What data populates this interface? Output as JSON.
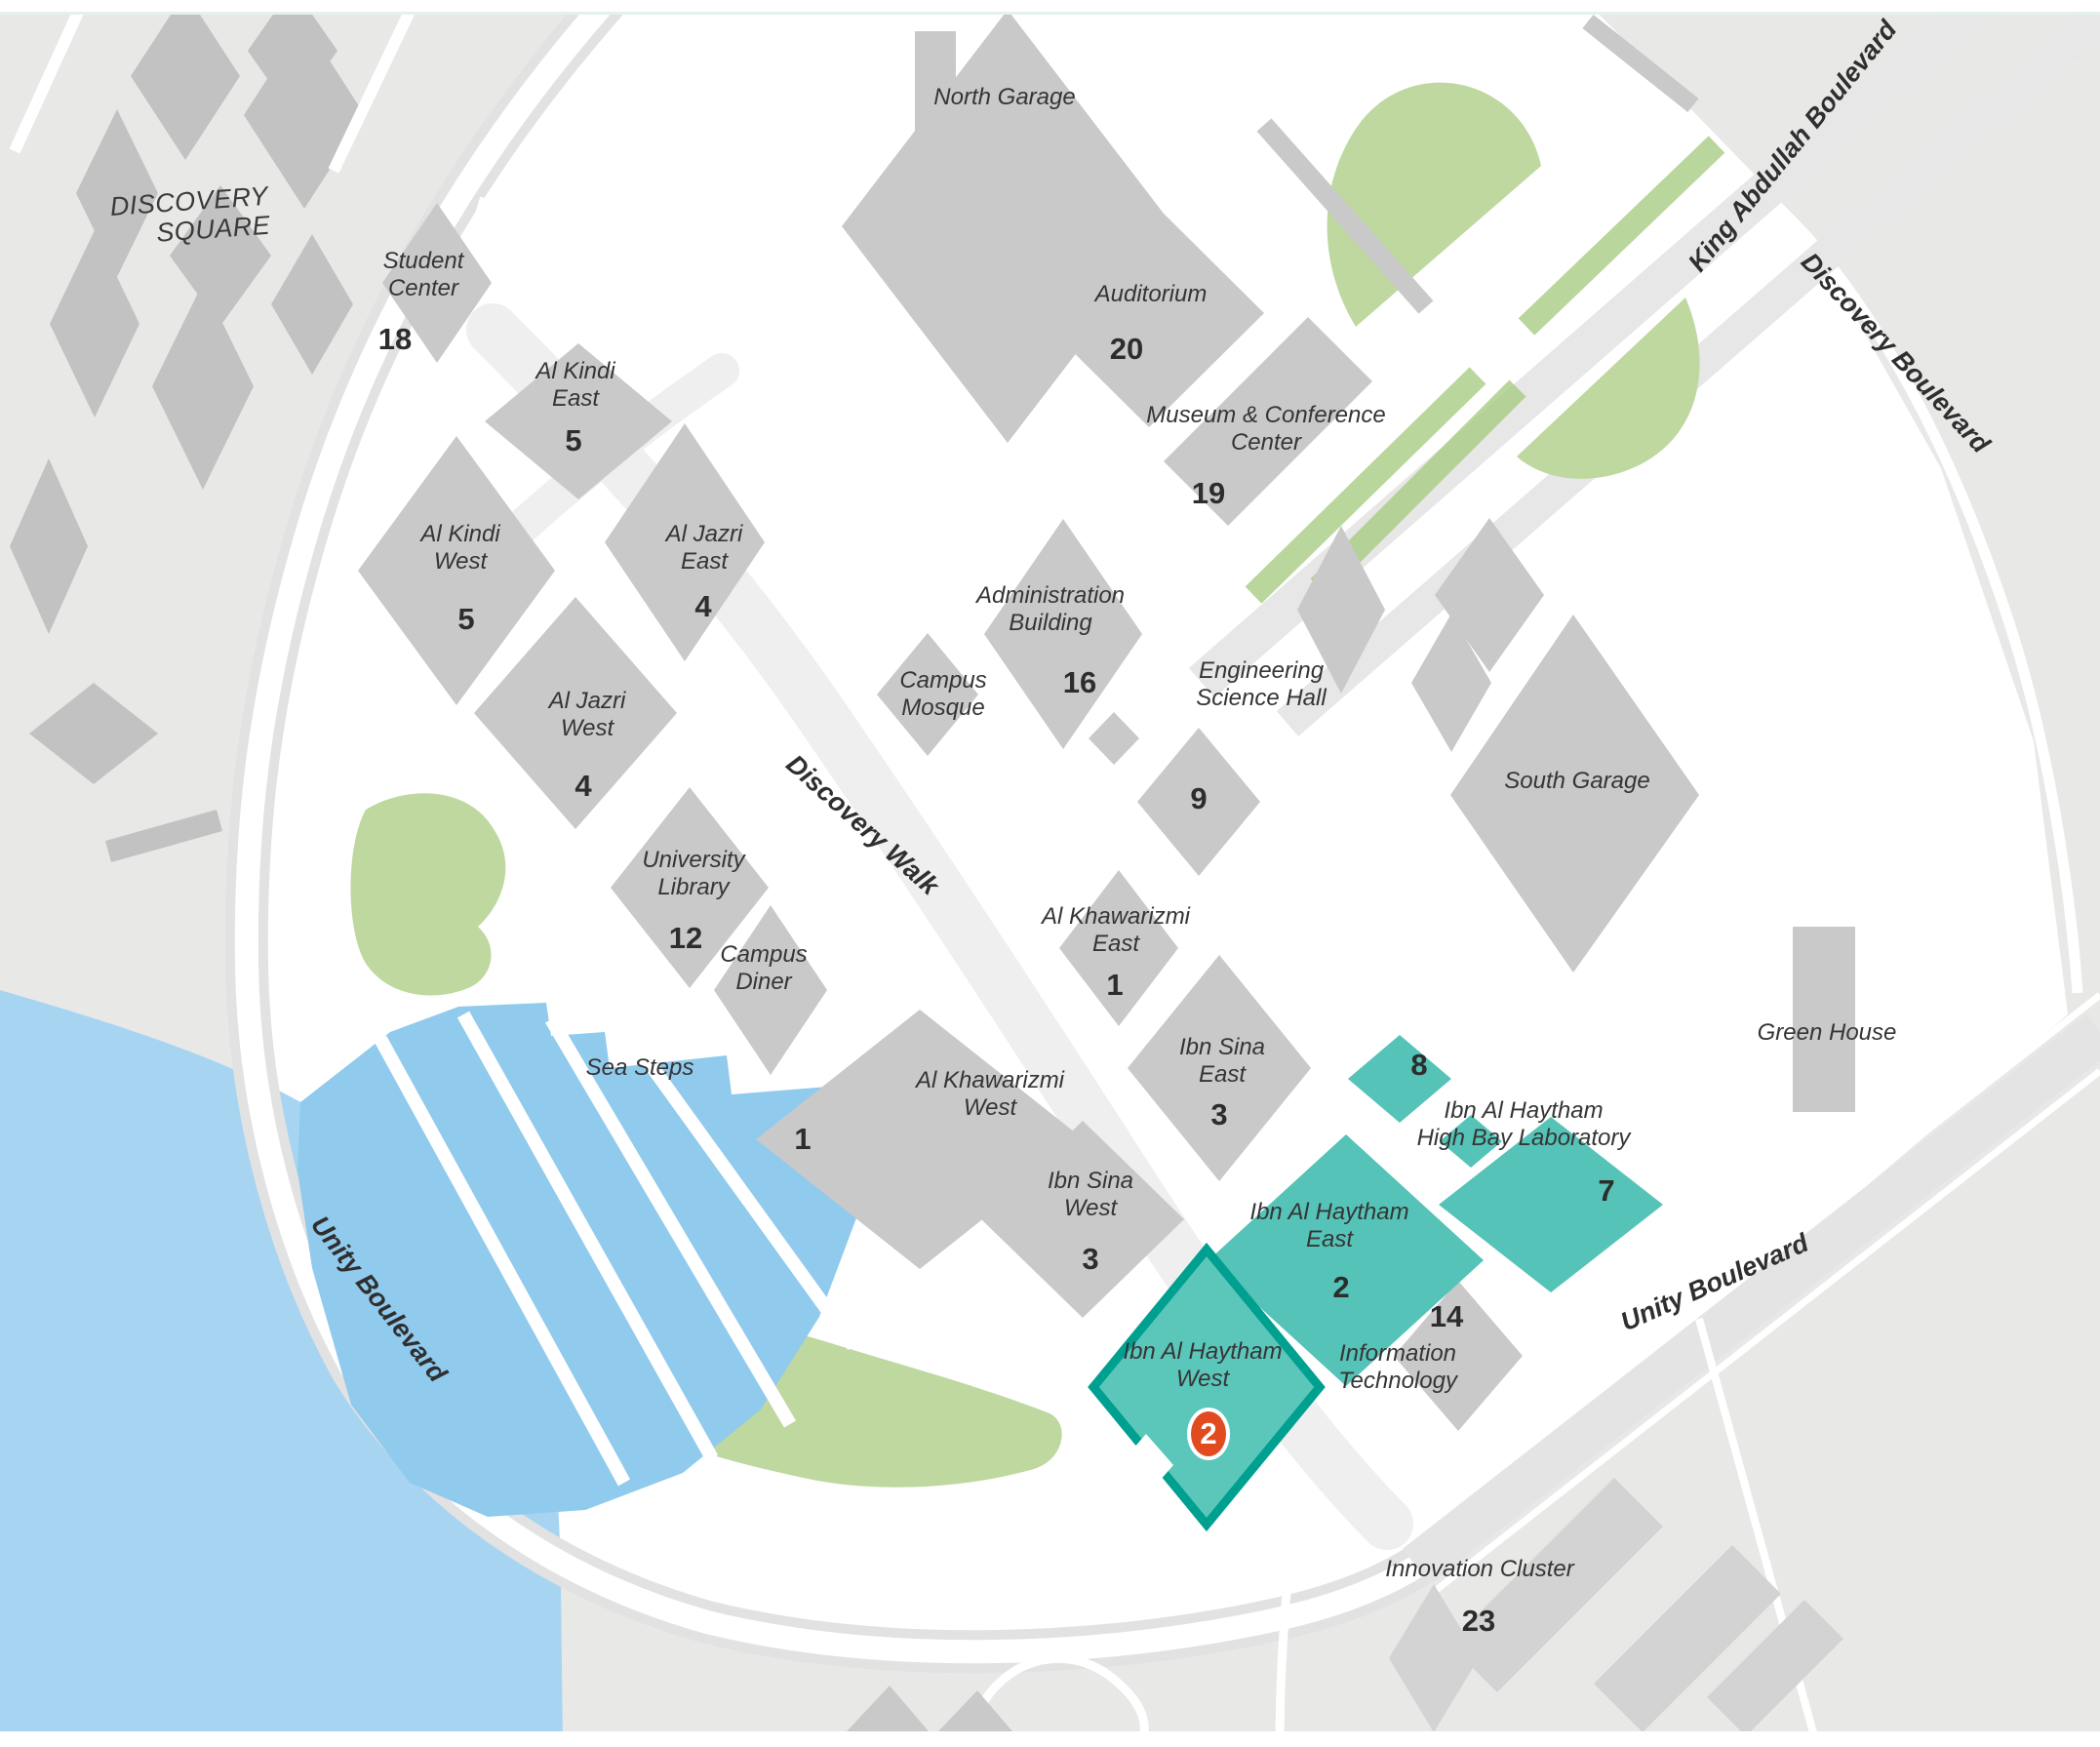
{
  "areas": {
    "discovery_square": "DISCOVERY\nSQUARE",
    "sea_steps": "Sea Steps",
    "innovation_cluster": {
      "name": "Innovation Cluster",
      "number": "23"
    }
  },
  "roads": {
    "king_abdullah": "King Abdullah Boulevard",
    "discovery_blvd": "Discovery Boulevard",
    "unity_left": "Unity Boulevard",
    "unity_right": "Unity Boulevard",
    "discovery_walk": "Discovery Walk"
  },
  "buildings": {
    "north_garage": {
      "name": "North Garage"
    },
    "student_center": {
      "name": "Student\nCenter",
      "number": "18"
    },
    "al_kindi_east": {
      "name": "Al Kindi\nEast",
      "number": "5"
    },
    "al_kindi_west": {
      "name": "Al Kindi\nWest",
      "number": "5"
    },
    "al_jazri_east": {
      "name": "Al Jazri\nEast",
      "number": "4"
    },
    "al_jazri_west": {
      "name": "Al Jazri\nWest",
      "number": "4"
    },
    "auditorium": {
      "name": "Auditorium",
      "number": "20"
    },
    "museum_conference": {
      "name": "Museum & Conference\nCenter",
      "number": "19"
    },
    "administration": {
      "name": "Administration\nBuilding",
      "number": "16"
    },
    "campus_mosque": {
      "name": "Campus\nMosque"
    },
    "engineering_science": {
      "name": "Engineering\nScience Hall",
      "number": "9"
    },
    "south_garage": {
      "name": "South Garage"
    },
    "university_library": {
      "name": "University\nLibrary",
      "number": "12"
    },
    "campus_diner": {
      "name": "Campus\nDiner"
    },
    "al_khawarizmi_east": {
      "name": "Al Khawarizmi\nEast",
      "number": "1"
    },
    "al_khawarizmi_west": {
      "name": "Al Khawarizmi\nWest",
      "number": "1"
    },
    "ibn_sina_east": {
      "name": "Ibn Sina\nEast",
      "number": "3"
    },
    "ibn_sina_west": {
      "name": "Ibn Sina\nWest",
      "number": "3"
    },
    "green_house": {
      "name": "Green House"
    },
    "high_bay_lab": {
      "name": "Ibn Al Haytham\nHigh Bay Laboratory",
      "number_upper": "8",
      "number_lower": "7"
    },
    "ibn_al_haytham_east": {
      "name": "Ibn Al Haytham\nEast",
      "number": "2"
    },
    "ibn_al_haytham_west": {
      "name": "Ibn Al Haytham\nWest"
    },
    "information_technology": {
      "name": "Information\nTechnology",
      "number": "14"
    }
  },
  "marker": {
    "number": "2",
    "color": "#e24a20"
  },
  "colors": {
    "water": "#a7d5f1",
    "sea_steps_blue": "#90caed",
    "greenery": "#bed8a0",
    "district_gray": "#e8e8e7",
    "building_gray": "#c9c9c9",
    "highlight_teal": "#55c3b7",
    "highlight_border_teal": "#00a090",
    "marker_orange": "#e24a20",
    "label_text": "#353535"
  }
}
